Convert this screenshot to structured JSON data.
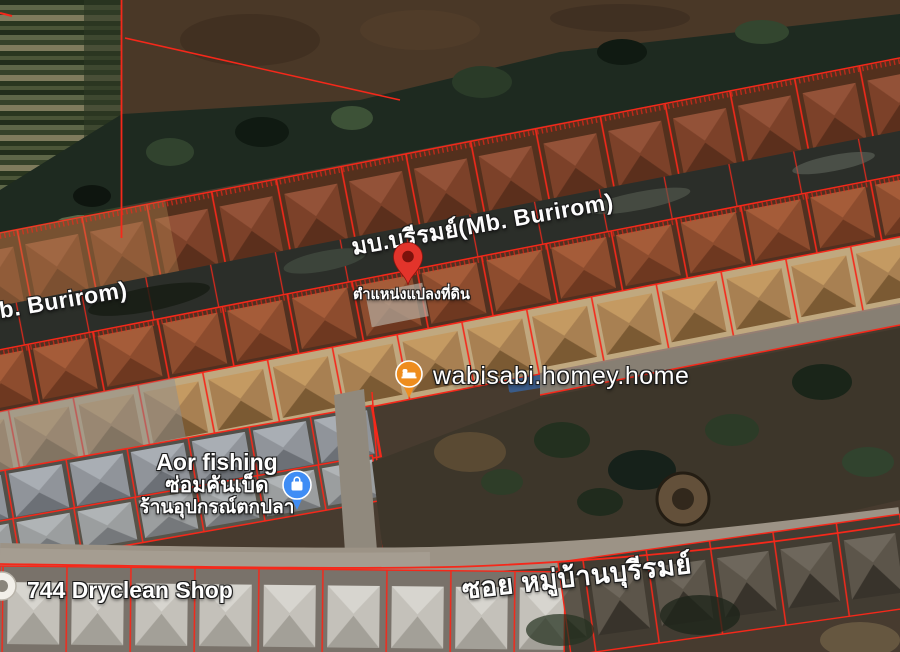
{
  "map": {
    "road_labels": {
      "main_center": "มบ.บุรีรมย์(Mb. Burirom)",
      "main_left": "(Mb. Burirom)",
      "soi": "ซอย หมู่บ้านบุรีรมย์"
    },
    "marker": {
      "caption": "ตำแหน่งแปลงที่ดิน"
    },
    "places": {
      "homestay": {
        "name": "wabisabi.homey.home"
      },
      "fishing_shop": {
        "name": "Aor fishing",
        "line2": "ซ่อมคันเบ็ด",
        "line3": "ร้านอุปกรณ์ตกปลา"
      },
      "dryclean": {
        "name": "744 Dryclean Shop"
      }
    },
    "colors": {
      "parcel_line": "#f5281a",
      "marker_red": "#e3342b",
      "pin_orange": "#ee8d1e",
      "pin_blue": "#3f8df5"
    }
  }
}
